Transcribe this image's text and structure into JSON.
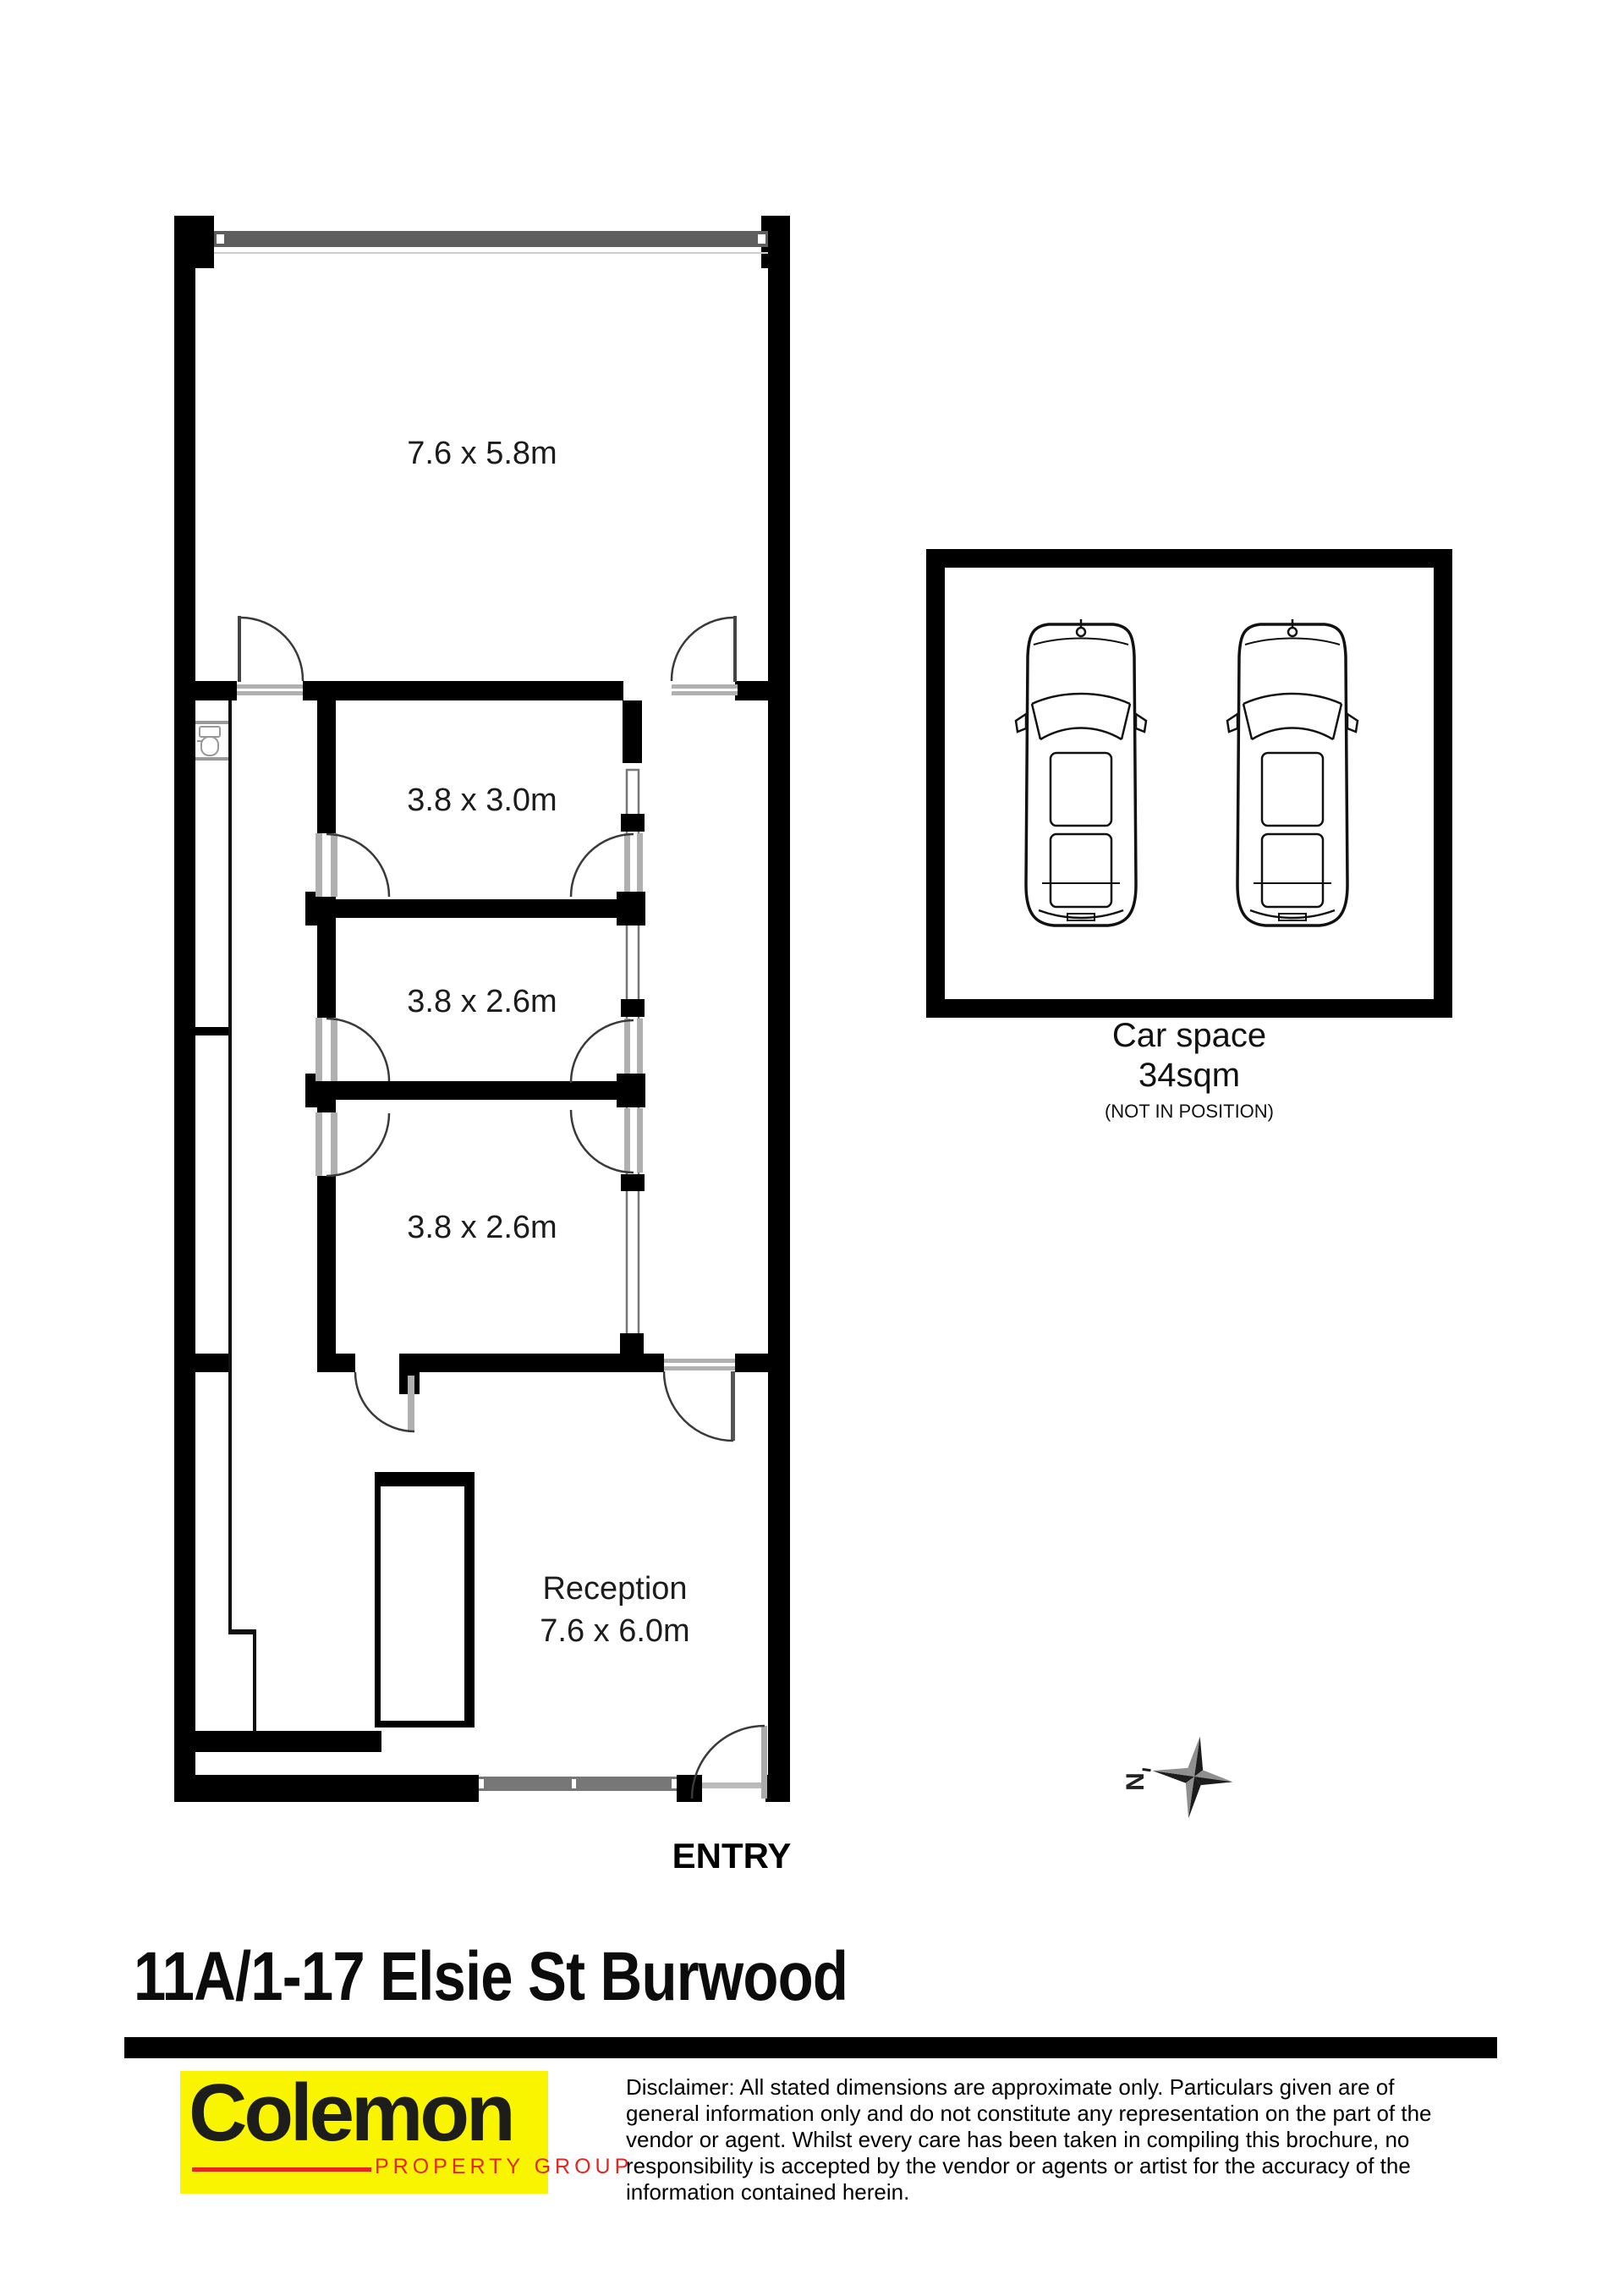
{
  "floorplan": {
    "rooms": [
      {
        "id": "room-top",
        "label": "7.6 x 5.8m"
      },
      {
        "id": "room-2",
        "label": "3.8 x 3.0m"
      },
      {
        "id": "room-3",
        "label": "3.8 x 2.6m"
      },
      {
        "id": "room-4",
        "label": "3.8 x 2.6m"
      },
      {
        "id": "reception",
        "name": "Reception",
        "label": "7.6 x 6.0m"
      }
    ],
    "entry_label": "ENTRY",
    "car_space": {
      "title": "Car space",
      "area": "34sqm",
      "note": "(NOT IN POSITION)",
      "icon": "car-top-view-icon",
      "count_cars": 2
    },
    "compass": {
      "label": "N",
      "icon": "compass-rose-icon"
    },
    "fixture": {
      "icon": "toilet-icon"
    },
    "colors": {
      "wall": "#000000",
      "window": "#5e5e5e",
      "door_sill": "#b0b0b0",
      "door_arc": "#3a3a3a"
    }
  },
  "address": {
    "title": "11A/1-17 Elsie St Burwood"
  },
  "footer": {
    "logo": {
      "name": "Colemon",
      "tagline": "PROPERTY GROUP",
      "background": "#f9f500",
      "name_color": "#1d1d1b",
      "tagline_color": "#e8251d"
    },
    "disclaimer": "Disclaimer: All stated dimensions are approximate only. Particulars given are of general information only and do not constitute any representation on the part of the vendor or agent. Whilst every care has been taken in compiling this brochure, no responsibility is accepted by the vendor or agents or artist for the accuracy of the information contained herein."
  }
}
